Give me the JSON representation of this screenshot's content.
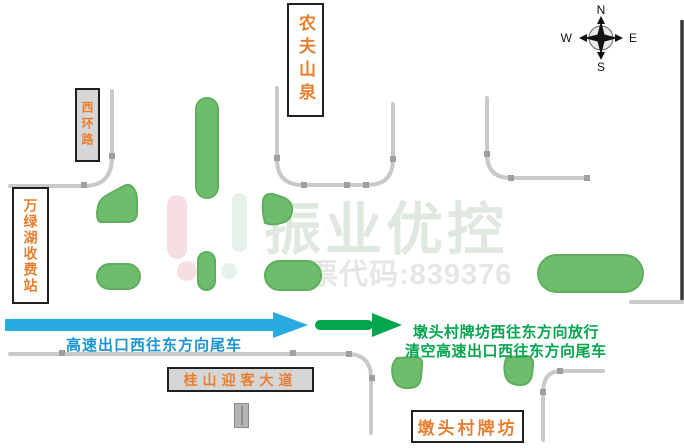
{
  "diagram": {
    "compass": {
      "north": "N",
      "south": "S",
      "east": "E",
      "west": "W"
    },
    "labels": {
      "nongfu_shanquan": "农夫山泉",
      "xi_huan_lu": "西环路",
      "wanlvhu_toll_station": "万绿湖收费站",
      "guishan_avenue": "桂山迎客大道",
      "duntou_archway": "墩头村牌坊"
    },
    "flows": {
      "blue_caption": "高速出口西往东方向尾车",
      "green_caption_line1": "墩头村牌坊西往东方向放行",
      "green_caption_line2": "清空高速出口西往东方向尾车"
    },
    "watermark": {
      "brand": "振业优控",
      "stock_line": "股票代码:839376"
    },
    "colors": {
      "label_text": "#e87e2e",
      "road_edge": "#c9c9c9",
      "road_tick": "#9f9f9f",
      "green_island_fill": "#6ebd6d",
      "green_island_stroke": "#5fae5e",
      "blue_flow": "#29abe2",
      "green_flow": "#04a54f",
      "box_gray_fill": "#d6d6d6"
    }
  }
}
